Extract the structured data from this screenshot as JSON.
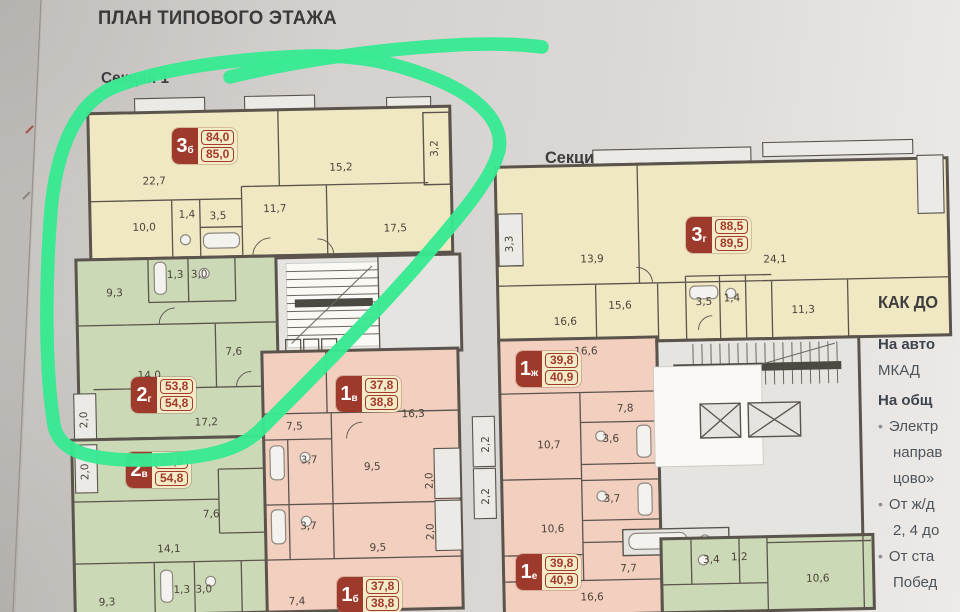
{
  "title": "ПЛАН ТИПОВОГО ЭТАЖА",
  "sections": {
    "s1": {
      "label": "Секция 1"
    },
    "s3": {
      "label": "Секция 3"
    }
  },
  "marker_color": "#38e992",
  "apartments": [
    {
      "num": "3",
      "letter": "б",
      "area_top": "84,0",
      "area_bottom": "85,0",
      "x": 172,
      "y": 128
    },
    {
      "num": "2",
      "letter": "г",
      "area_top": "53,8",
      "area_bottom": "54,8",
      "x": 131,
      "y": 377
    },
    {
      "num": "2",
      "letter": "в",
      "area_top": "53,8",
      "area_bottom": "54,8",
      "x": 126,
      "y": 452
    },
    {
      "num": "1",
      "letter": "в",
      "area_top": "37,8",
      "area_bottom": "38,8",
      "x": 336,
      "y": 376
    },
    {
      "num": "1",
      "letter": "б",
      "area_top": "37,8",
      "area_bottom": "38,8",
      "x": 337,
      "y": 577
    },
    {
      "num": "3",
      "letter": "г",
      "area_top": "88,5",
      "area_bottom": "89,5",
      "x": 686,
      "y": 217
    },
    {
      "num": "1",
      "letter": "ж",
      "area_top": "39,8",
      "area_bottom": "40,9",
      "x": 516,
      "y": 351
    },
    {
      "num": "1",
      "letter": "е",
      "area_top": "39,8",
      "area_bottom": "40,9",
      "x": 516,
      "y": 554
    }
  ],
  "plans": {
    "section1": {
      "room_labels": [
        {
          "t": "22,7",
          "x": 158,
          "y": 182
        },
        {
          "t": "15,2",
          "x": 345,
          "y": 172
        },
        {
          "t": "3,2",
          "x": 442,
          "y": 152,
          "r": 1
        },
        {
          "t": "11,7",
          "x": 278,
          "y": 212
        },
        {
          "t": "17,5",
          "x": 398,
          "y": 234
        },
        {
          "t": "10,0",
          "x": 147,
          "y": 228
        },
        {
          "t": "1,4",
          "x": 190,
          "y": 216
        },
        {
          "t": "3,5",
          "x": 221,
          "y": 218
        },
        {
          "t": "9,3",
          "x": 116,
          "y": 293
        },
        {
          "t": "1,3",
          "x": 177,
          "y": 276
        },
        {
          "t": "3,0",
          "x": 201,
          "y": 276
        },
        {
          "t": "14,0",
          "x": 149,
          "y": 376
        },
        {
          "t": "7,6",
          "x": 234,
          "y": 354
        },
        {
          "t": "17,2",
          "x": 205,
          "y": 424
        },
        {
          "t": "2,0",
          "x": 86,
          "y": 416,
          "r": 1
        },
        {
          "t": "2,0",
          "x": 86,
          "y": 468,
          "r": 1
        },
        {
          "t": "7,6",
          "x": 208,
          "y": 516
        },
        {
          "t": "14,1",
          "x": 165,
          "y": 550
        },
        {
          "t": "9,3",
          "x": 102,
          "y": 602
        },
        {
          "t": "1,3",
          "x": 177,
          "y": 591
        },
        {
          "t": "3,0",
          "x": 199,
          "y": 591
        },
        {
          "t": "7,5",
          "x": 293,
          "y": 430
        },
        {
          "t": "16,3",
          "x": 412,
          "y": 420
        },
        {
          "t": "3,7",
          "x": 307,
          "y": 464
        },
        {
          "t": "9,5",
          "x": 370,
          "y": 472
        },
        {
          "t": "2,0",
          "x": 430,
          "y": 484,
          "r": 1
        },
        {
          "t": "3,7",
          "x": 305,
          "y": 530
        },
        {
          "t": "9,5",
          "x": 374,
          "y": 553
        },
        {
          "t": "7,4",
          "x": 292,
          "y": 605
        },
        {
          "t": "2,0",
          "x": 430,
          "y": 535,
          "r": 1
        }
      ]
    },
    "section3": {
      "room_labels": [
        {
          "t": "3,3",
          "x": 516,
          "y": 240,
          "r": 1
        },
        {
          "t": "13,9",
          "x": 595,
          "y": 260
        },
        {
          "t": "24,1",
          "x": 778,
          "y": 264
        },
        {
          "t": "16,6",
          "x": 567,
          "y": 322
        },
        {
          "t": "15,6",
          "x": 622,
          "y": 307
        },
        {
          "t": "3,5",
          "x": 706,
          "y": 305
        },
        {
          "t": "1,4",
          "x": 734,
          "y": 302
        },
        {
          "t": "11,3",
          "x": 805,
          "y": 315
        },
        {
          "t": "16,6",
          "x": 587,
          "y": 352
        },
        {
          "t": "2,2",
          "x": 488,
          "y": 440,
          "r": 1
        },
        {
          "t": "2,2",
          "x": 487,
          "y": 492,
          "r": 1
        },
        {
          "t": "7,8",
          "x": 625,
          "y": 410
        },
        {
          "t": "10,7",
          "x": 548,
          "y": 445
        },
        {
          "t": "3,6",
          "x": 610,
          "y": 440
        },
        {
          "t": "3,7",
          "x": 610,
          "y": 500
        },
        {
          "t": "10,6",
          "x": 550,
          "y": 529
        },
        {
          "t": "7,7",
          "x": 625,
          "y": 570
        },
        {
          "t": "16,6",
          "x": 588,
          "y": 598
        },
        {
          "t": "3,4",
          "x": 708,
          "y": 563
        },
        {
          "t": "1,2",
          "x": 736,
          "y": 561
        },
        {
          "t": "10,6",
          "x": 814,
          "y": 584
        }
      ]
    }
  },
  "info_panel": {
    "heading": "КАК ДО",
    "lines": [
      {
        "text": "На авто",
        "bold": true
      },
      {
        "text": "МКАД"
      },
      {
        "text": "На общ",
        "bold": true
      },
      {
        "text": "Электр",
        "bullet": true
      },
      {
        "text": "направ",
        "indent": true
      },
      {
        "text": "цово»",
        "indent": true
      },
      {
        "text": "От ж/д",
        "bullet": true
      },
      {
        "text": "2, 4 до",
        "indent": true
      },
      {
        "text": "От ста",
        "bullet": true
      },
      {
        "text": "Побед",
        "indent": true
      }
    ]
  }
}
